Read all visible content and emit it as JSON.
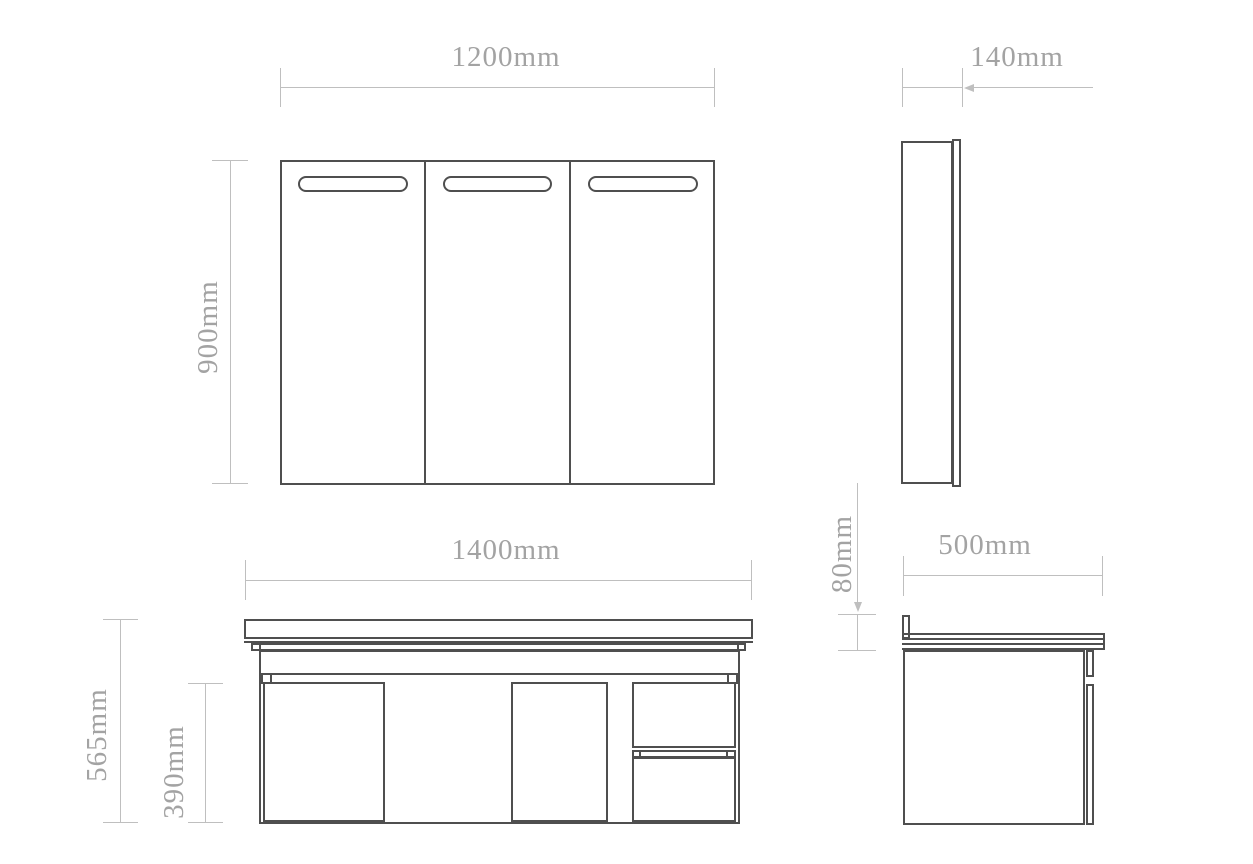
{
  "drawing": {
    "type": "technical-dimension-drawing",
    "unit": "mm",
    "colors": {
      "outline": "#4f4f4f",
      "dimension_line": "#bfbfbf",
      "dimension_text": "#a3a3a3",
      "background": "#ffffff"
    },
    "views": {
      "mirror_cabinet_front": {
        "width_label": "1200mm",
        "height_label": "900mm",
        "door_count": 3
      },
      "mirror_cabinet_side": {
        "depth_label": "140mm"
      },
      "vanity_front": {
        "width_label": "1400mm",
        "total_height_label": "565mm",
        "cabinet_height_label": "390mm"
      },
      "vanity_side": {
        "depth_label": "500mm",
        "counter_offset_label": "80mm"
      }
    }
  }
}
